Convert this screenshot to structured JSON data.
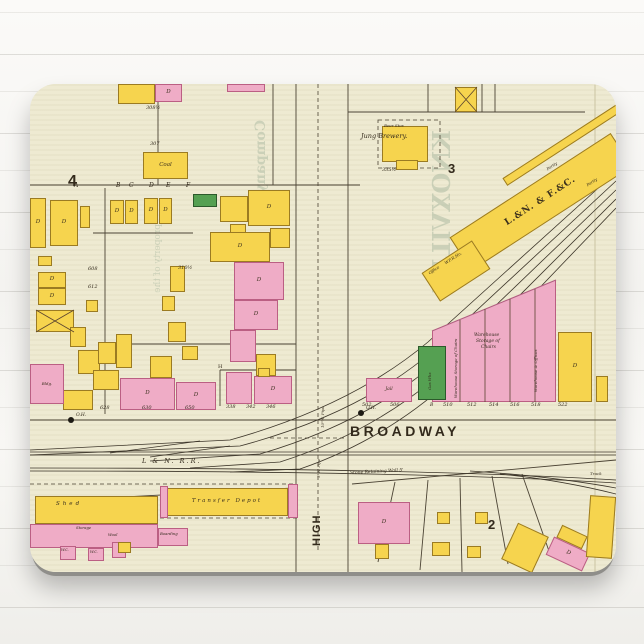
{
  "product": {
    "type": "mousepad with vintage fire-insurance map print"
  },
  "colors": {
    "paper": "#eeead2",
    "building_frame_yellow": "#f6d44e",
    "building_brick_pink": "#efacc6",
    "building_special_green": "#55a052",
    "ink": "#332a1c",
    "bleed_through": "#a9b8a0",
    "pad_edge": "#8f8e8a"
  },
  "map": {
    "street_names": {
      "broadway": "BROADWAY",
      "high": "HIGH",
      "railroad": "L & N. R.R."
    },
    "block_numbers": [
      "4",
      "3",
      "2"
    ],
    "labels": [
      {
        "t": "4",
        "x": 38,
        "y": 90,
        "s": 16,
        "f": "sans",
        "b": 1
      },
      {
        "t": "3",
        "x": 418,
        "y": 78,
        "s": 13,
        "f": "sans",
        "b": 1
      },
      {
        "t": "2",
        "x": 458,
        "y": 434,
        "s": 13,
        "f": "sans",
        "b": 1
      },
      {
        "t": "BROADWAY",
        "x": 320,
        "y": 340,
        "s": 14,
        "f": "sans",
        "b": 1,
        "sp": 3.5
      },
      {
        "t": "L & N. R.R.",
        "x": 112,
        "y": 374,
        "s": 6.5,
        "i": 1,
        "sp": 2
      },
      {
        "t": "HIGH",
        "x": 282,
        "y": 462,
        "s": 11,
        "f": "sans",
        "b": 1,
        "r": -90,
        "sp": 1
      },
      {
        "t": "5\"W. Pipe",
        "x": 287,
        "y": 394,
        "s": 4,
        "i": 1,
        "r": -90
      },
      {
        "t": "10\"W. Pipe",
        "x": 291,
        "y": 344,
        "s": 4,
        "i": 1,
        "r": -90
      },
      {
        "t": "Stone Retaining Wall 5'",
        "x": 320,
        "y": 388,
        "s": 4.5,
        "i": 1,
        "r": -3
      },
      {
        "t": "Jung Brewery.",
        "x": 331,
        "y": 49,
        "s": 6.5,
        "i": 1
      },
      {
        "t": "Beer Stor.",
        "x": 354,
        "y": 40,
        "s": 4,
        "i": 1
      },
      {
        "t": "335½",
        "x": 352,
        "y": 84,
        "s": 5,
        "i": 1
      },
      {
        "t": "307",
        "x": 120,
        "y": 58,
        "s": 5,
        "i": 1
      },
      {
        "t": "308½",
        "x": 116,
        "y": 22,
        "s": 5,
        "i": 1
      },
      {
        "t": "A",
        "x": 44,
        "y": 99,
        "s": 6,
        "i": 1
      },
      {
        "t": "B",
        "x": 86,
        "y": 99,
        "s": 6,
        "i": 1
      },
      {
        "t": "C",
        "x": 99,
        "y": 99,
        "s": 6,
        "i": 1
      },
      {
        "t": "D",
        "x": 119,
        "y": 99,
        "s": 6,
        "i": 1
      },
      {
        "t": "E",
        "x": 136,
        "y": 99,
        "s": 6,
        "i": 1
      },
      {
        "t": "F",
        "x": 156,
        "y": 99,
        "s": 6,
        "i": 1
      },
      {
        "t": "628",
        "x": 70,
        "y": 322,
        "s": 5,
        "i": 1
      },
      {
        "t": "630",
        "x": 112,
        "y": 322,
        "s": 5,
        "i": 1
      },
      {
        "t": "650",
        "x": 155,
        "y": 322,
        "s": 5,
        "i": 1
      },
      {
        "t": "338",
        "x": 196,
        "y": 321,
        "s": 5,
        "i": 1
      },
      {
        "t": "342",
        "x": 216,
        "y": 321,
        "s": 5,
        "i": 1
      },
      {
        "t": "346",
        "x": 236,
        "y": 321,
        "s": 5,
        "i": 1
      },
      {
        "t": "502",
        "x": 332,
        "y": 319,
        "s": 5,
        "i": 1
      },
      {
        "t": "506",
        "x": 360,
        "y": 319,
        "s": 5,
        "i": 1
      },
      {
        "t": "B",
        "x": 400,
        "y": 320,
        "s": 4.5,
        "i": 1
      },
      {
        "t": "510",
        "x": 413,
        "y": 319,
        "s": 5,
        "i": 1
      },
      {
        "t": "512",
        "x": 437,
        "y": 319,
        "s": 5,
        "i": 1
      },
      {
        "t": "514",
        "x": 459,
        "y": 319,
        "s": 5,
        "i": 1
      },
      {
        "t": "516",
        "x": 480,
        "y": 319,
        "s": 5,
        "i": 1
      },
      {
        "t": "518",
        "x": 501,
        "y": 319,
        "s": 5,
        "i": 1
      },
      {
        "t": "522",
        "x": 528,
        "y": 319,
        "s": 5,
        "i": 1
      },
      {
        "t": "O.H.",
        "x": 46,
        "y": 330,
        "s": 4.5,
        "i": 1
      },
      {
        "t": "O.H.",
        "x": 336,
        "y": 323,
        "s": 4.5,
        "i": 1
      },
      {
        "t": "608",
        "x": 58,
        "y": 183,
        "s": 5,
        "i": 1
      },
      {
        "t": "612",
        "x": 58,
        "y": 201,
        "s": 5,
        "i": 1
      },
      {
        "t": "310½",
        "x": 148,
        "y": 182,
        "s": 5,
        "i": 1
      },
      {
        "t": "H",
        "x": 188,
        "y": 281,
        "s": 5
      },
      {
        "t": "Office",
        "x": 398,
        "y": 188,
        "s": 4,
        "i": 1,
        "r": -33
      },
      {
        "t": "W.F.R.Ho.",
        "x": 414,
        "y": 178,
        "s": 4,
        "i": 1,
        "r": -33
      },
      {
        "t": "Partly",
        "x": 516,
        "y": 84,
        "s": 4,
        "i": 1,
        "r": -33
      },
      {
        "t": "Partly",
        "x": 556,
        "y": 100,
        "s": 4,
        "i": 1,
        "r": -33
      },
      {
        "t": "Warehouse",
        "x": 444,
        "y": 250,
        "s": 4.5,
        "i": 1
      },
      {
        "t": "Storage of",
        "x": 446,
        "y": 256,
        "s": 4.5,
        "i": 1
      },
      {
        "t": "Chairs",
        "x": 451,
        "y": 262,
        "s": 4.5,
        "i": 1
      },
      {
        "t": "Warehouse Storage of Chairs",
        "x": 424,
        "y": 314,
        "s": 4,
        "i": 1,
        "r": -90
      },
      {
        "t": "Warehouse & Offices",
        "x": 504,
        "y": 308,
        "s": 4,
        "i": 1,
        "r": -90
      },
      {
        "t": "Gas Wks",
        "x": 398,
        "y": 306,
        "s": 4,
        "i": 1,
        "r": -90
      },
      {
        "t": "Shed",
        "x": 26,
        "y": 418,
        "s": 5.5,
        "i": 1,
        "sp": 3
      },
      {
        "t": "Storage",
        "x": 46,
        "y": 442,
        "s": 3.8,
        "i": 1
      },
      {
        "t": "Wool",
        "x": 78,
        "y": 449,
        "s": 3.8,
        "i": 1
      },
      {
        "t": "Boarding",
        "x": 130,
        "y": 448,
        "s": 3.8,
        "i": 1
      },
      {
        "t": "W.C.",
        "x": 31,
        "y": 465,
        "s": 3.5,
        "i": 1
      },
      {
        "t": "W.C.",
        "x": 60,
        "y": 467,
        "s": 3.5,
        "i": 1
      },
      {
        "t": "Track",
        "x": 560,
        "y": 388,
        "s": 4,
        "i": 1
      },
      {
        "t": "KNOXVILLE",
        "x": 400,
        "y": 46,
        "s": 24,
        "r": 90,
        "m": 1,
        "c": "bleed",
        "b": 1
      },
      {
        "t": "Company of",
        "x": 224,
        "y": 36,
        "s": 14,
        "r": 90,
        "m": 1,
        "c": "bleed",
        "b": 1
      },
      {
        "t": "property of the",
        "x": 124,
        "y": 140,
        "s": 9,
        "r": 90,
        "m": 1,
        "c": "bleed"
      }
    ],
    "buildings": [
      {
        "x": 88,
        "y": 0,
        "w": 37,
        "h": 20,
        "c": "y"
      },
      {
        "x": 125,
        "y": 0,
        "w": 27,
        "h": 18,
        "c": "p",
        "l": "D"
      },
      {
        "x": 197,
        "y": 0,
        "w": 38,
        "h": 8,
        "c": "p"
      },
      {
        "x": 113,
        "y": 68,
        "w": 45,
        "h": 27,
        "c": "y",
        "l": "Coal",
        "ls": 5.5
      },
      {
        "x": 425,
        "y": 3,
        "w": 22,
        "h": 25,
        "c": "y"
      },
      {
        "x": 352,
        "y": 42,
        "w": 46,
        "h": 36,
        "c": "y"
      },
      {
        "x": 366,
        "y": 76,
        "w": 22,
        "h": 10,
        "c": "y"
      },
      {
        "x": 415,
        "y": 98,
        "w": 192,
        "h": 40,
        "c": "y",
        "rot": -33,
        "l": "L.&N. & F.&C.",
        "ls": 9,
        "b": 1,
        "lsp": 1
      },
      {
        "x": 396,
        "y": 170,
        "w": 60,
        "h": 34,
        "c": "y",
        "rot": -33
      },
      {
        "x": 462,
        "y": 50,
        "w": 160,
        "h": 9,
        "c": "y",
        "rot": -33
      },
      {
        "x": 0,
        "y": 114,
        "w": 16,
        "h": 50,
        "c": "y",
        "l": "D"
      },
      {
        "x": 20,
        "y": 116,
        "w": 28,
        "h": 46,
        "c": "y",
        "l": "D"
      },
      {
        "x": 50,
        "y": 122,
        "w": 10,
        "h": 22,
        "c": "y"
      },
      {
        "x": 8,
        "y": 172,
        "w": 14,
        "h": 10,
        "c": "y"
      },
      {
        "x": 8,
        "y": 188,
        "w": 28,
        "h": 16,
        "c": "y",
        "l": "D"
      },
      {
        "x": 8,
        "y": 204,
        "w": 28,
        "h": 17,
        "c": "y",
        "l": "D"
      },
      {
        "x": 6,
        "y": 226,
        "w": 38,
        "h": 22,
        "c": "y"
      },
      {
        "x": 56,
        "y": 216,
        "w": 12,
        "h": 12,
        "c": "y"
      },
      {
        "x": 40,
        "y": 243,
        "w": 16,
        "h": 20,
        "c": "y"
      },
      {
        "x": 48,
        "y": 266,
        "w": 22,
        "h": 24,
        "c": "y"
      },
      {
        "x": 80,
        "y": 116,
        "w": 14,
        "h": 24,
        "c": "y",
        "l": "D"
      },
      {
        "x": 95,
        "y": 116,
        "w": 13,
        "h": 24,
        "c": "y",
        "l": "D"
      },
      {
        "x": 114,
        "y": 114,
        "w": 14,
        "h": 26,
        "c": "y",
        "l": "D"
      },
      {
        "x": 129,
        "y": 114,
        "w": 13,
        "h": 26,
        "c": "y",
        "l": "D"
      },
      {
        "x": 163,
        "y": 110,
        "w": 24,
        "h": 13,
        "c": "g"
      },
      {
        "x": 190,
        "y": 112,
        "w": 28,
        "h": 26,
        "c": "y"
      },
      {
        "x": 218,
        "y": 106,
        "w": 42,
        "h": 36,
        "c": "y",
        "l": "D"
      },
      {
        "x": 200,
        "y": 140,
        "w": 16,
        "h": 12,
        "c": "y"
      },
      {
        "x": 180,
        "y": 148,
        "w": 60,
        "h": 30,
        "c": "y",
        "l": "D"
      },
      {
        "x": 240,
        "y": 144,
        "w": 20,
        "h": 20,
        "c": "y"
      },
      {
        "x": 204,
        "y": 178,
        "w": 50,
        "h": 38,
        "c": "p",
        "l": "D"
      },
      {
        "x": 204,
        "y": 216,
        "w": 44,
        "h": 30,
        "c": "p",
        "l": "D"
      },
      {
        "x": 140,
        "y": 182,
        "w": 15,
        "h": 26,
        "c": "y"
      },
      {
        "x": 132,
        "y": 212,
        "w": 13,
        "h": 15,
        "c": "y"
      },
      {
        "x": 138,
        "y": 238,
        "w": 18,
        "h": 20,
        "c": "y"
      },
      {
        "x": 152,
        "y": 262,
        "w": 16,
        "h": 14,
        "c": "y"
      },
      {
        "x": 68,
        "y": 258,
        "w": 18,
        "h": 22,
        "c": "y"
      },
      {
        "x": 86,
        "y": 250,
        "w": 16,
        "h": 34,
        "c": "y"
      },
      {
        "x": 200,
        "y": 246,
        "w": 26,
        "h": 32,
        "c": "p"
      },
      {
        "x": 226,
        "y": 270,
        "w": 20,
        "h": 22,
        "c": "y"
      },
      {
        "x": 63,
        "y": 286,
        "w": 26,
        "h": 20,
        "c": "y"
      },
      {
        "x": 33,
        "y": 306,
        "w": 30,
        "h": 20,
        "c": "y"
      },
      {
        "x": 90,
        "y": 294,
        "w": 55,
        "h": 32,
        "c": "p",
        "l": "D"
      },
      {
        "x": 146,
        "y": 298,
        "w": 40,
        "h": 28,
        "c": "p",
        "l": "D"
      },
      {
        "x": 120,
        "y": 272,
        "w": 22,
        "h": 22,
        "c": "y"
      },
      {
        "x": 0,
        "y": 280,
        "w": 34,
        "h": 40,
        "c": "p",
        "l": "Bldg.",
        "ls": 4
      },
      {
        "x": 196,
        "y": 288,
        "w": 26,
        "h": 32,
        "c": "p"
      },
      {
        "x": 224,
        "y": 292,
        "w": 38,
        "h": 28,
        "c": "p",
        "l": "D"
      },
      {
        "x": 228,
        "y": 284,
        "w": 12,
        "h": 9,
        "c": "y"
      },
      {
        "x": 402,
        "y": 196,
        "w": 124,
        "h": 122,
        "c": "p",
        "clip": "polygon(0 42%, 100% 0, 100% 100%, 0 100%)"
      },
      {
        "x": 388,
        "y": 262,
        "w": 28,
        "h": 54,
        "c": "g"
      },
      {
        "x": 528,
        "y": 248,
        "w": 34,
        "h": 70,
        "c": "y",
        "l": "D"
      },
      {
        "x": 336,
        "y": 294,
        "w": 46,
        "h": 24,
        "c": "p",
        "l": "Jail",
        "ls": 4.5
      },
      {
        "x": 566,
        "y": 292,
        "w": 12,
        "h": 26,
        "c": "y"
      },
      {
        "x": 5,
        "y": 412,
        "w": 123,
        "h": 28,
        "c": "y"
      },
      {
        "x": 136,
        "y": 404,
        "w": 122,
        "h": 28,
        "c": "y",
        "l": "Transfer Depot",
        "ls": 5.5,
        "lsp": 2
      },
      {
        "x": 130,
        "y": 402,
        "w": 8,
        "h": 32,
        "c": "p"
      },
      {
        "x": 258,
        "y": 400,
        "w": 10,
        "h": 34,
        "c": "p"
      },
      {
        "x": 0,
        "y": 440,
        "w": 128,
        "h": 24,
        "c": "p"
      },
      {
        "x": 30,
        "y": 462,
        "w": 16,
        "h": 14,
        "c": "p"
      },
      {
        "x": 58,
        "y": 464,
        "w": 16,
        "h": 13,
        "c": "p"
      },
      {
        "x": 82,
        "y": 458,
        "w": 14,
        "h": 16,
        "c": "p"
      },
      {
        "x": 128,
        "y": 444,
        "w": 30,
        "h": 18,
        "c": "p"
      },
      {
        "x": 88,
        "y": 458,
        "w": 13,
        "h": 11,
        "c": "y"
      },
      {
        "x": 328,
        "y": 418,
        "w": 52,
        "h": 42,
        "c": "p",
        "l": "D"
      },
      {
        "x": 345,
        "y": 460,
        "w": 14,
        "h": 15,
        "c": "y"
      },
      {
        "x": 407,
        "y": 428,
        "w": 13,
        "h": 12,
        "c": "y"
      },
      {
        "x": 445,
        "y": 428,
        "w": 13,
        "h": 12,
        "c": "y"
      },
      {
        "x": 402,
        "y": 458,
        "w": 18,
        "h": 14,
        "c": "y"
      },
      {
        "x": 437,
        "y": 462,
        "w": 14,
        "h": 12,
        "c": "y"
      },
      {
        "x": 478,
        "y": 444,
        "w": 34,
        "h": 40,
        "c": "y",
        "rot": 25
      },
      {
        "x": 528,
        "y": 446,
        "w": 28,
        "h": 14,
        "c": "y",
        "rot": 25
      },
      {
        "x": 518,
        "y": 460,
        "w": 40,
        "h": 20,
        "c": "p",
        "rot": 25,
        "l": "D"
      },
      {
        "x": 558,
        "y": 412,
        "w": 26,
        "h": 62,
        "c": "y",
        "rot": 4
      }
    ],
    "dots": [
      {
        "x": 38,
        "y": 333
      },
      {
        "x": 328,
        "y": 326
      }
    ]
  }
}
